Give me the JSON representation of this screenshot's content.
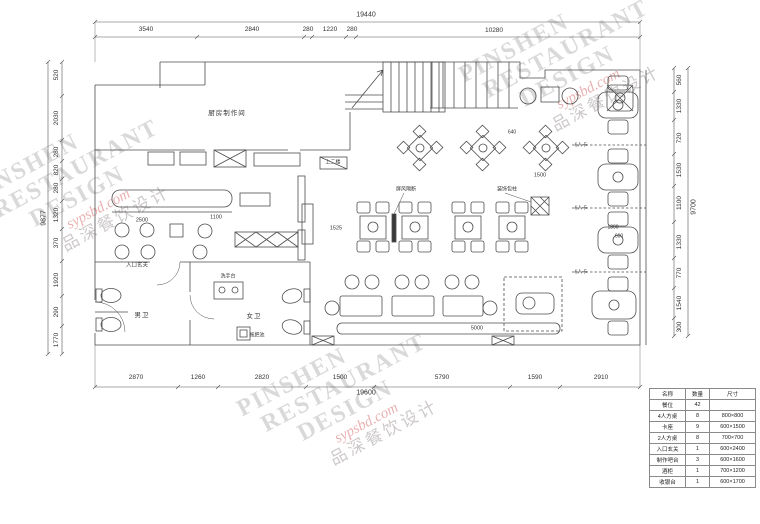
{
  "watermark": {
    "en1": "PINSHEN",
    "en2": "RESTAURANT",
    "en3": "DESIGN",
    "site": "sypsbd.com",
    "cn": "品深餐饮设计",
    "accent": "#db7d7d"
  },
  "dims": {
    "top": {
      "total": "19440",
      "segments": [
        "3540",
        "2840",
        "280",
        "1220",
        "280",
        "10280"
      ]
    },
    "bottom": {
      "total": "19600",
      "segments": [
        "2870",
        "1260",
        "2820",
        "1500",
        "5790",
        "1590",
        "2910"
      ]
    },
    "left": {
      "total": "9877",
      "segments": [
        "520",
        "2030",
        "280",
        "820",
        "280",
        "1320",
        "370",
        "1920",
        "290",
        "1770"
      ]
    },
    "right": {
      "total": "9700",
      "segments": [
        "560",
        "1330",
        "720",
        "1530",
        "1100",
        "1330",
        "770",
        "1540",
        "300"
      ]
    }
  },
  "rooms": {
    "kitchen": "厨房制作间",
    "stairs": "上二楼",
    "mens": "男卫",
    "womens": "女卫",
    "entry": "入口玄关",
    "sink": "洗手台",
    "mop": "拖把池",
    "booth": "6人卡",
    "screen": "屏风隔断",
    "column": "装饰包柱"
  },
  "inline_dims": {
    "bench": "2500",
    "aisle": "1100",
    "walk": "1525",
    "gap": "1500",
    "bar": "5000",
    "booth_w": "1800",
    "booth_d": "600",
    "diamond": "640"
  },
  "legend": {
    "headers": [
      "名称",
      "数量",
      "尺寸"
    ],
    "rows": [
      [
        "餐位",
        "42",
        ""
      ],
      [
        "4人方桌",
        "8",
        "800×800"
      ],
      [
        "卡座",
        "9",
        "600×1500"
      ],
      [
        "2人方桌",
        "8",
        "700×700"
      ],
      [
        "入口玄关",
        "1",
        "600×2400"
      ],
      [
        "制作吧台",
        "3",
        "600×1600"
      ],
      [
        "酒柜",
        "1",
        "700×1200"
      ],
      [
        "收银台",
        "1",
        "600×1700"
      ]
    ]
  }
}
